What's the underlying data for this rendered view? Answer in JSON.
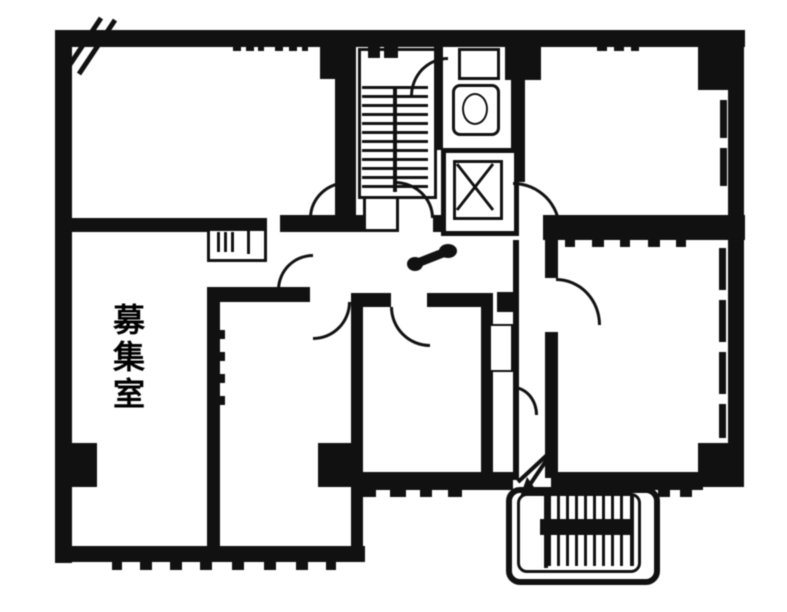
{
  "plan": {
    "room_label": "募集室",
    "colors": {
      "line": "#161616",
      "background": "#ffffff"
    },
    "icons": {
      "staircase": "staircase-hatch-icon",
      "elevator": "elevator-x-icon",
      "external_staircase": "external-staircase-hatch-icon",
      "entrance_arrow": "entrance-arrow-icon",
      "toilet": "toilet-fixture-icon",
      "doors": "door-swing-arc-icon",
      "corner_mark": "corner-diagonal-mark-icon"
    }
  }
}
